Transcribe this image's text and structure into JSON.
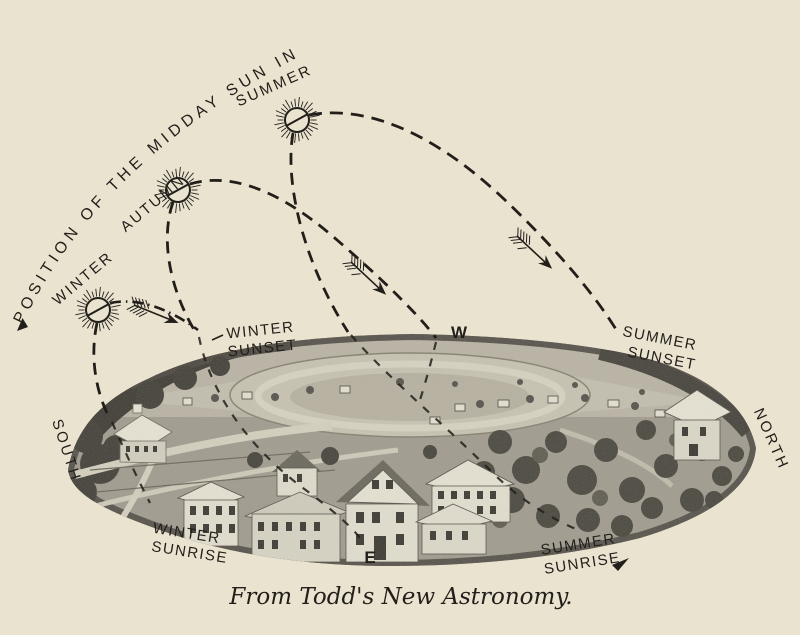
{
  "figure": {
    "arc_title": "POSITION OF THE MIDDAY SUN IN",
    "caption": "From Todd's New Astronomy.",
    "seasons": {
      "winter": "WINTER",
      "autumn": "AUTUMN",
      "summer": "SUMMER"
    },
    "events": {
      "winter_sunset": [
        "WINTER",
        "SUNSET"
      ],
      "summer_sunset": [
        "SUMMER",
        "SUNSET"
      ],
      "winter_sunrise": [
        "WINTER",
        "SUNRISE"
      ],
      "summer_sunrise": [
        "SUMMER",
        "SUNRISE"
      ]
    },
    "compass": {
      "west": "W",
      "east": "E",
      "south": "SOUTH",
      "north": "NORTH"
    },
    "icons": [
      "sun-icon",
      "feathered-arrow-icon",
      "sunrise-arrow-icon"
    ],
    "colors": {
      "paper": "#eae3d0",
      "ink": "#221f1a",
      "photo_mid": "#a19b8e",
      "photo_dark": "#45423a",
      "photo_light": "#d5d0be"
    }
  }
}
